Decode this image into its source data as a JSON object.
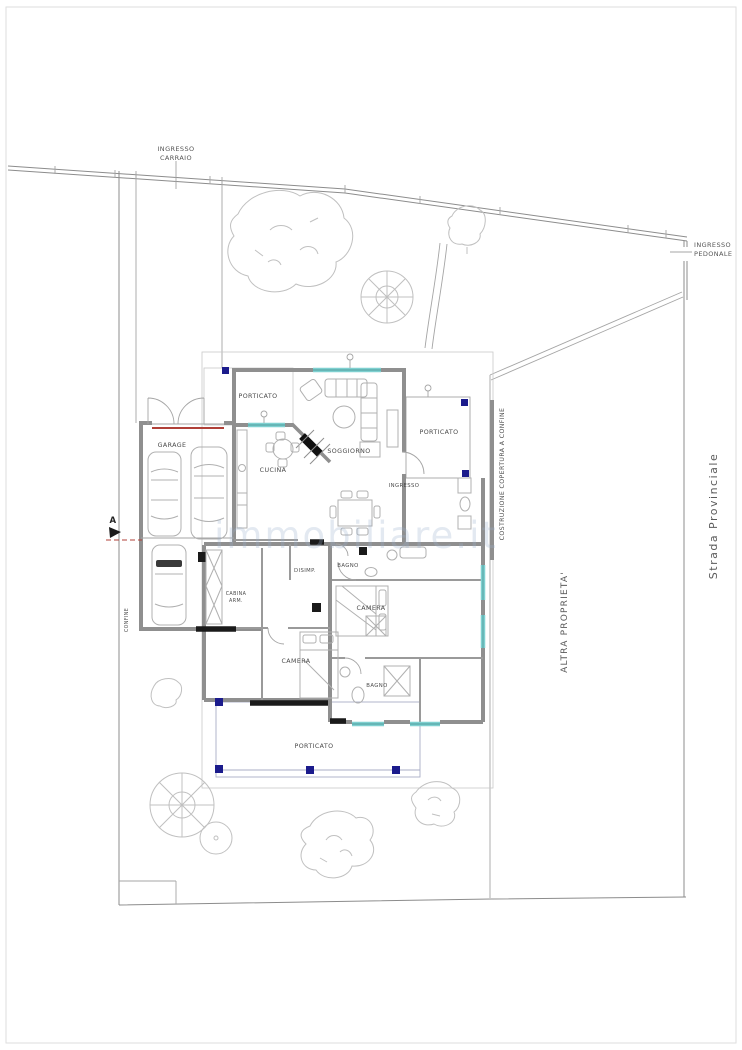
{
  "document": {
    "kind": "architectural site and floor plan",
    "language": "Italian"
  },
  "colors": {
    "wall_gray": "#8f8f8f",
    "window_teal": "#7fd0d0",
    "column_navy": "#1b1b8c",
    "garage_door_red": "#b04038",
    "ink": "#1a1a1a",
    "watermark_blue": "#9ab2cf"
  },
  "site": {
    "ingresso_carraio": {
      "line1": "INGRESSO",
      "line2": "CARRAIO"
    },
    "ingresso_pedonale": {
      "line1": "INGRESSO",
      "line2": "PEDONALE"
    },
    "strada_provinciale": "Strada  Provinciale",
    "costruzione_copertura": "COSTRUZIONE COPERTURA A CONFINE",
    "altra_proprieta": "ALTRA  PROPRIETA'",
    "confine": "CONFINE",
    "section_marker": "A"
  },
  "rooms": {
    "garage": "GARAGE",
    "porticato_nord": "PORTICATO",
    "soggiorno": "SOGGIORNO",
    "cucina": "CUCINA",
    "porticato_est": "PORTICATO",
    "ingresso": "INGRESSO",
    "disimpegno": "DISIMP.",
    "bagno_1": "BAGNO",
    "camera_1": "CAMERA",
    "camera_2": "CAMERA",
    "bagno_2": "BAGNO",
    "cabina_armadio": {
      "line1": "CABINA",
      "line2": "ARM."
    },
    "porticato_sud": "PORTICATO"
  },
  "watermark": "immobiliare.it"
}
